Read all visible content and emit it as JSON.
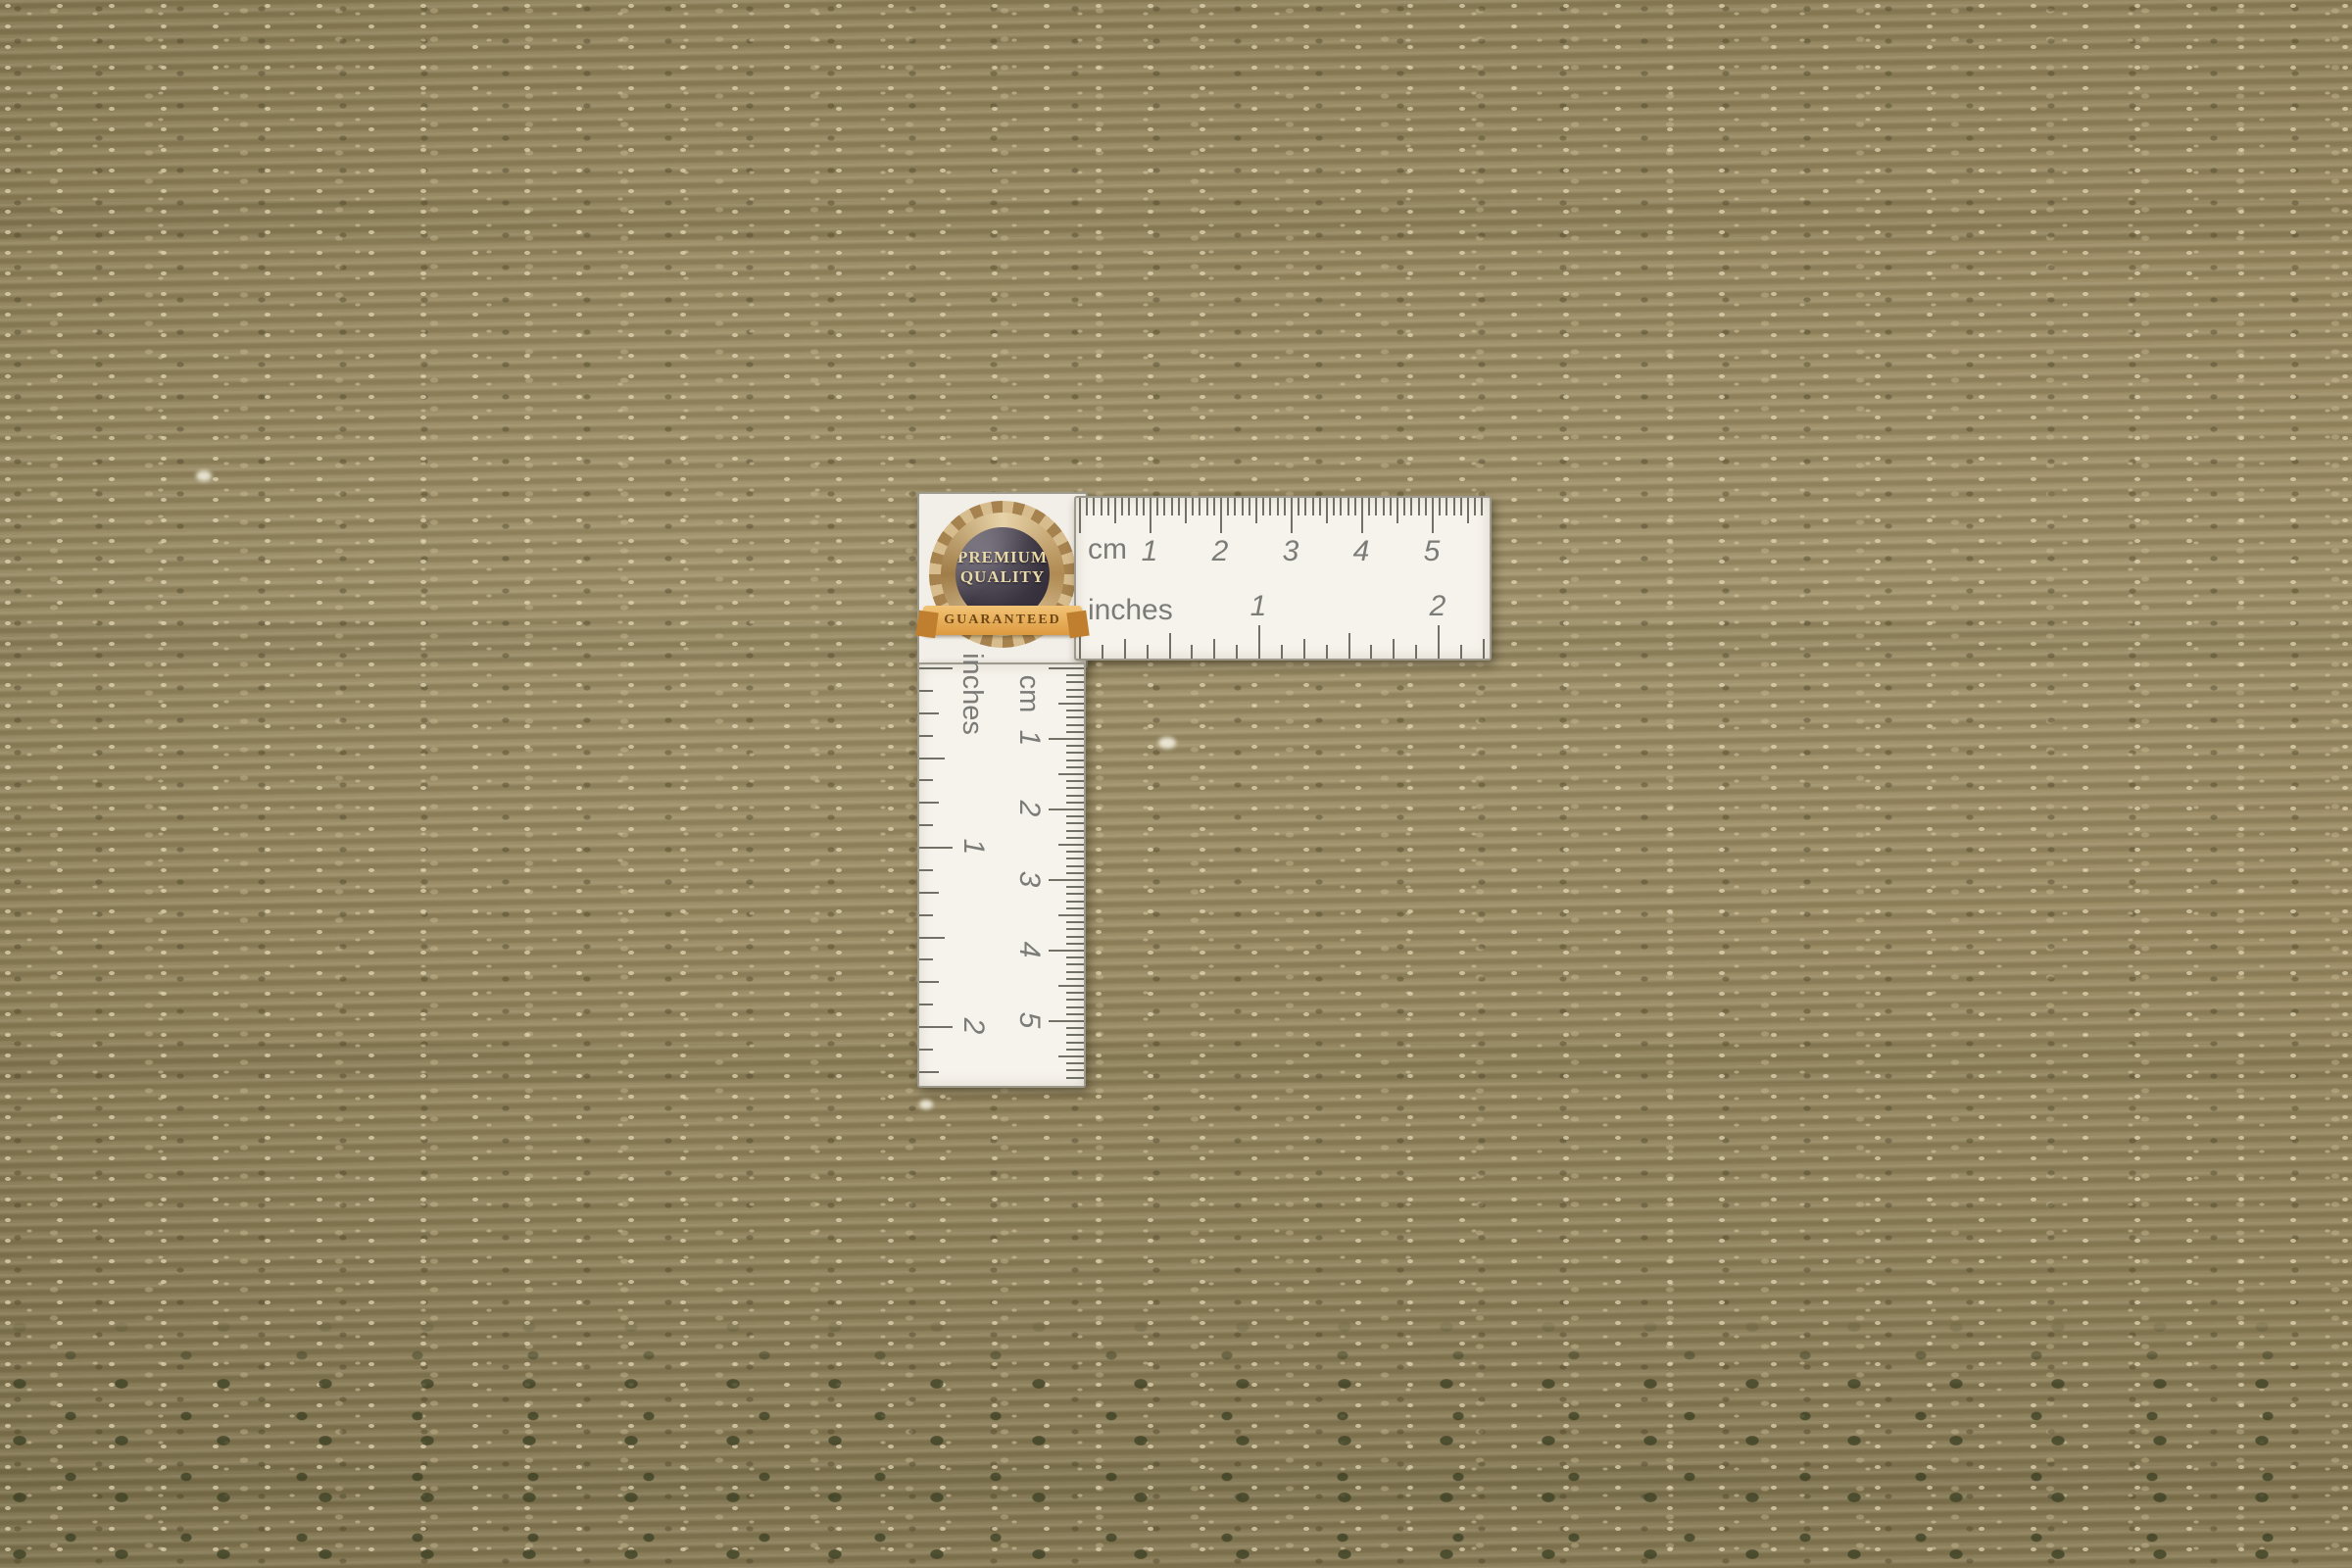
{
  "badge": {
    "title_line1": "PREMIUM",
    "title_line2": "QUALITY",
    "ribbon_text": "GUARANTEED"
  },
  "horizontal_ruler": {
    "cm_label": "cm",
    "cm_numbers": [
      1,
      2,
      3,
      4,
      5
    ],
    "inch_label": "inches",
    "inch_numbers": [
      1,
      2
    ]
  },
  "vertical_ruler": {
    "cm_label": "cm",
    "cm_numbers": [
      1,
      2,
      3,
      4,
      5
    ],
    "inch_label": "inches",
    "inch_numbers": [
      1,
      2
    ]
  },
  "colors": {
    "rug_base": "#96875f",
    "rug_dark_fleck": "#49422a",
    "rug_light_fleck": "#e2d6af",
    "knot_dot": "#3e4226",
    "ruler_bg": "#f6f3ec",
    "tick": "#59594f",
    "ruler_number": "#7b7b78",
    "badge_ring_gold": "#c9a265",
    "badge_center": "#3a3440",
    "badge_text_gold": "#ead9a8",
    "ribbon_orange": "#dd9a40",
    "ribbon_text": "#6d4716"
  }
}
